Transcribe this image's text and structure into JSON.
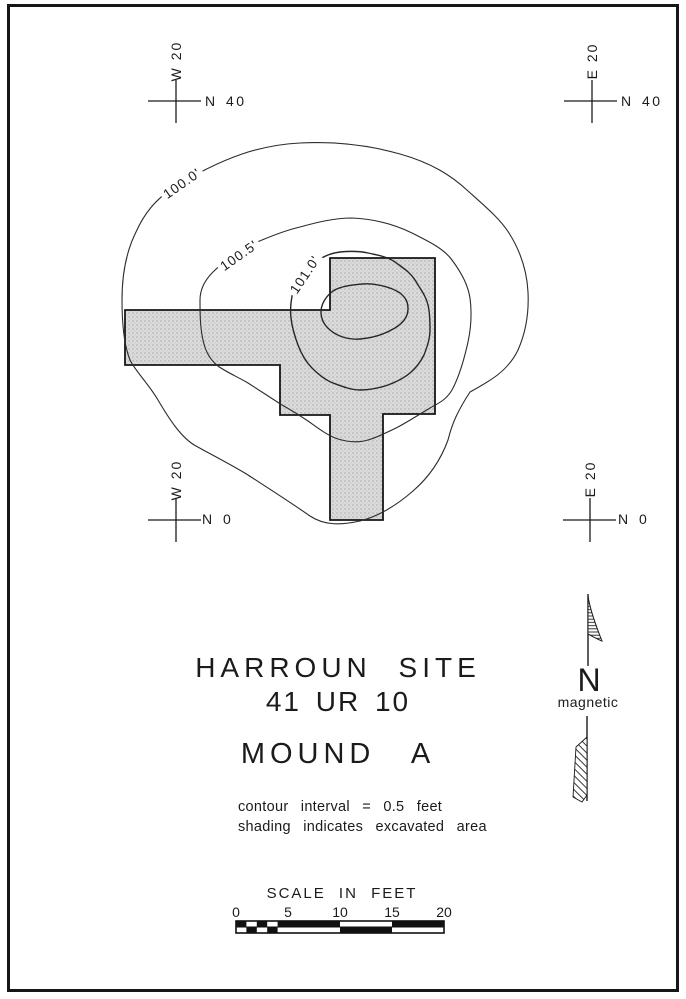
{
  "sheet": {
    "paper_color": "#ffffff",
    "ink_color": "#1b1b1b",
    "shading_color": "#dbdbdb"
  },
  "grid": {
    "nw": {
      "vertical": "W 20",
      "horizontal": "N 40"
    },
    "ne": {
      "vertical": "E 20",
      "horizontal": "N 40"
    },
    "sw": {
      "vertical": "W 20",
      "horizontal": "N 0"
    },
    "se": {
      "vertical": "E 20",
      "horizontal": "N 0"
    }
  },
  "contours": {
    "label_100_0": "100.0'",
    "label_100_5": "100.5'",
    "label_101_0": "101.0'",
    "elevations_feet": [
      100.0,
      100.5,
      101.0
    ],
    "interval_feet": 0.5
  },
  "north_arrow": {
    "letter": "N",
    "caption": "magnetic"
  },
  "title_block": {
    "site_name": "HARROUN SITE",
    "site_number": "41 UR 10",
    "mound": "MOUND A"
  },
  "notes": {
    "line1": "contour interval = 0.5 feet",
    "line2": "shading indicates excavated area"
  },
  "scale_bar": {
    "caption": "SCALE IN FEET",
    "ticks": [
      "0",
      "5",
      "10",
      "15",
      "20"
    ],
    "max_feet": 20
  },
  "map": {
    "kind": "archaeological site contour map",
    "excavated_area": "stippled cross-shaped excavation block",
    "grid_points": [
      "W20 N40",
      "E20 N40",
      "W20 N0",
      "E20 N0"
    ]
  }
}
